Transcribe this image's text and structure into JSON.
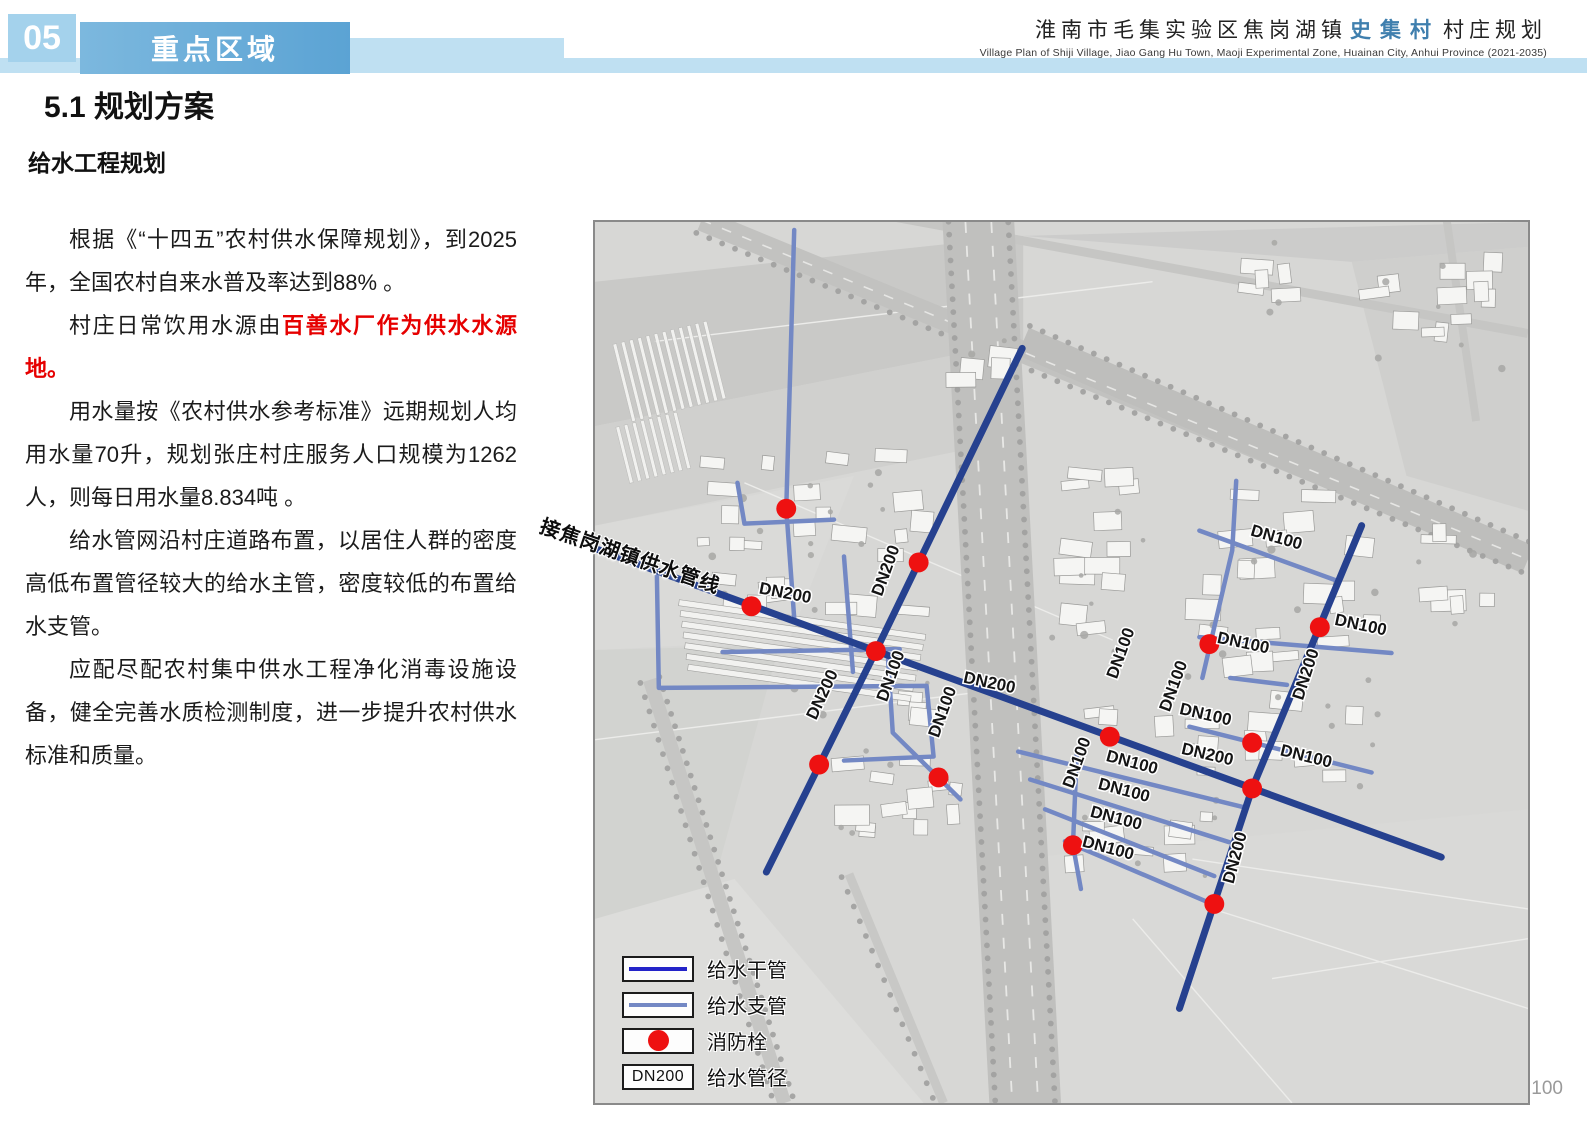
{
  "header": {
    "chapter_number": "05",
    "chapter_title": "重点区域",
    "project_title_prefix": "淮南市毛集实验区焦岗湖镇",
    "project_title_highlight": "史集村",
    "project_title_suffix": "村庄规划",
    "project_subtitle": "Village Plan of Shiji Village, Jiao Gang Hu Town, Maoji Experimental Zone, Huainan City, Anhui Province (2021-2035)"
  },
  "section": {
    "title": "5.1 规划方案",
    "subtitle": "给水工程规划"
  },
  "paragraphs": [
    {
      "runs": [
        {
          "t": "根据《“十四五”农村供水保障规划》，到2025年，全国农村自来水普及率达到88% 。"
        }
      ]
    },
    {
      "runs": [
        {
          "t": "村庄日常饮用水源由"
        },
        {
          "t": "百善水厂作为供水水源地。",
          "red": true
        }
      ]
    },
    {
      "runs": [
        {
          "t": "用水量按《农村供水参考标准》远期规划人均用水量70升，规划张庄村庄服务人口规模为1262人，则每日用水量8.834吨 。"
        }
      ]
    },
    {
      "runs": [
        {
          "t": "给水管网沿村庄道路布置，以居住人群的密度高低布置管径较大的给水主管，密度较低的布置给水支管。"
        }
      ]
    },
    {
      "runs": [
        {
          "t": "应配尽配农村集中供水工程净化消毒设施设备，健全完善水质检测制度，进一步提升农村供水标准和质量。"
        }
      ]
    }
  ],
  "map": {
    "feed_label": "接焦岗湖镇供水管线",
    "colors": {
      "main_pipe": "#26418f",
      "branch_pipe": "#7388c4",
      "hydrant": "#ee1111",
      "legend_main": "#2323c8",
      "legend_branch": "#7388c4"
    },
    "mains": [
      {
        "path": "M0,328 L850,638"
      },
      {
        "path": "M429,127 L282,431 L172,653"
      },
      {
        "path": "M770,305 L660,569 L587,790"
      }
    ],
    "branches": [
      {
        "path": "M200,8 L192,288 L200,398"
      },
      {
        "path": "M143,262 L150,303 L240,299"
      },
      {
        "path": "M62,352 L64,468 L333,466 L340,537 L250,541"
      },
      {
        "path": "M128,432 L306,429"
      },
      {
        "path": "M250,336 L259,452"
      },
      {
        "path": "M294,435 L299,513 L367,580"
      },
      {
        "path": "M607,310 L747,361"
      },
      {
        "path": "M644,260 L640,330 L610,458"
      },
      {
        "path": "M607,417 L800,433"
      },
      {
        "path": "M638,458 L695,465"
      },
      {
        "path": "M597,507 L780,553"
      },
      {
        "path": "M484,530 L480,626 L488,670"
      },
      {
        "path": "M425,532 L652,588"
      },
      {
        "path": "M437,560 L637,623"
      },
      {
        "path": "M452,590 L622,657"
      },
      {
        "path": "M472,622 L615,683"
      }
    ],
    "hydrants": [
      {
        "x": 192,
        "y": 288
      },
      {
        "x": 157,
        "y": 386
      },
      {
        "x": 282,
        "y": 431
      },
      {
        "x": 325,
        "y": 342
      },
      {
        "x": 225,
        "y": 545
      },
      {
        "x": 345,
        "y": 558
      },
      {
        "x": 517,
        "y": 517
      },
      {
        "x": 660,
        "y": 569
      },
      {
        "x": 622,
        "y": 685
      },
      {
        "x": 480,
        "y": 626
      },
      {
        "x": 617,
        "y": 424
      },
      {
        "x": 728,
        "y": 407
      },
      {
        "x": 660,
        "y": 523
      }
    ],
    "labels": [
      {
        "text": "DN200",
        "x": 190,
        "y": 378,
        "rot": 11
      },
      {
        "text": "DN200",
        "x": 297,
        "y": 352,
        "rot": -70
      },
      {
        "text": "DN200",
        "x": 395,
        "y": 468,
        "rot": 12
      },
      {
        "text": "DN200",
        "x": 233,
        "y": 477,
        "rot": -65
      },
      {
        "text": "DN200",
        "x": 614,
        "y": 540,
        "rot": 13
      },
      {
        "text": "DN200",
        "x": 648,
        "y": 640,
        "rot": -75
      },
      {
        "text": "DN200",
        "x": 719,
        "y": 456,
        "rot": -72
      },
      {
        "text": "DN100",
        "x": 302,
        "y": 458,
        "rot": -70
      },
      {
        "text": "DN100",
        "x": 354,
        "y": 494,
        "rot": -70
      },
      {
        "text": "DN100",
        "x": 533,
        "y": 435,
        "rot": -70
      },
      {
        "text": "DN100",
        "x": 586,
        "y": 468,
        "rot": -70
      },
      {
        "text": "DN100",
        "x": 683,
        "y": 322,
        "rot": 16
      },
      {
        "text": "DN100",
        "x": 650,
        "y": 428,
        "rot": 12
      },
      {
        "text": "DN100",
        "x": 768,
        "y": 410,
        "rot": 12
      },
      {
        "text": "DN100",
        "x": 612,
        "y": 500,
        "rot": 13
      },
      {
        "text": "DN100",
        "x": 713,
        "y": 542,
        "rot": 14
      },
      {
        "text": "DN100",
        "x": 538,
        "y": 548,
        "rot": 15
      },
      {
        "text": "DN100",
        "x": 530,
        "y": 576,
        "rot": 15
      },
      {
        "text": "DN100",
        "x": 522,
        "y": 604,
        "rot": 15
      },
      {
        "text": "DN100",
        "x": 514,
        "y": 634,
        "rot": 15
      },
      {
        "text": "DN100",
        "x": 489,
        "y": 545,
        "rot": -70
      }
    ],
    "legend": {
      "items": [
        {
          "type": "main",
          "label": "给水干管"
        },
        {
          "type": "branch",
          "label": "给水支管"
        },
        {
          "type": "hydrant",
          "label": "消防栓"
        },
        {
          "type": "diameter",
          "label": "给水管径",
          "sample": "DN200"
        }
      ]
    }
  },
  "page_number": "100"
}
